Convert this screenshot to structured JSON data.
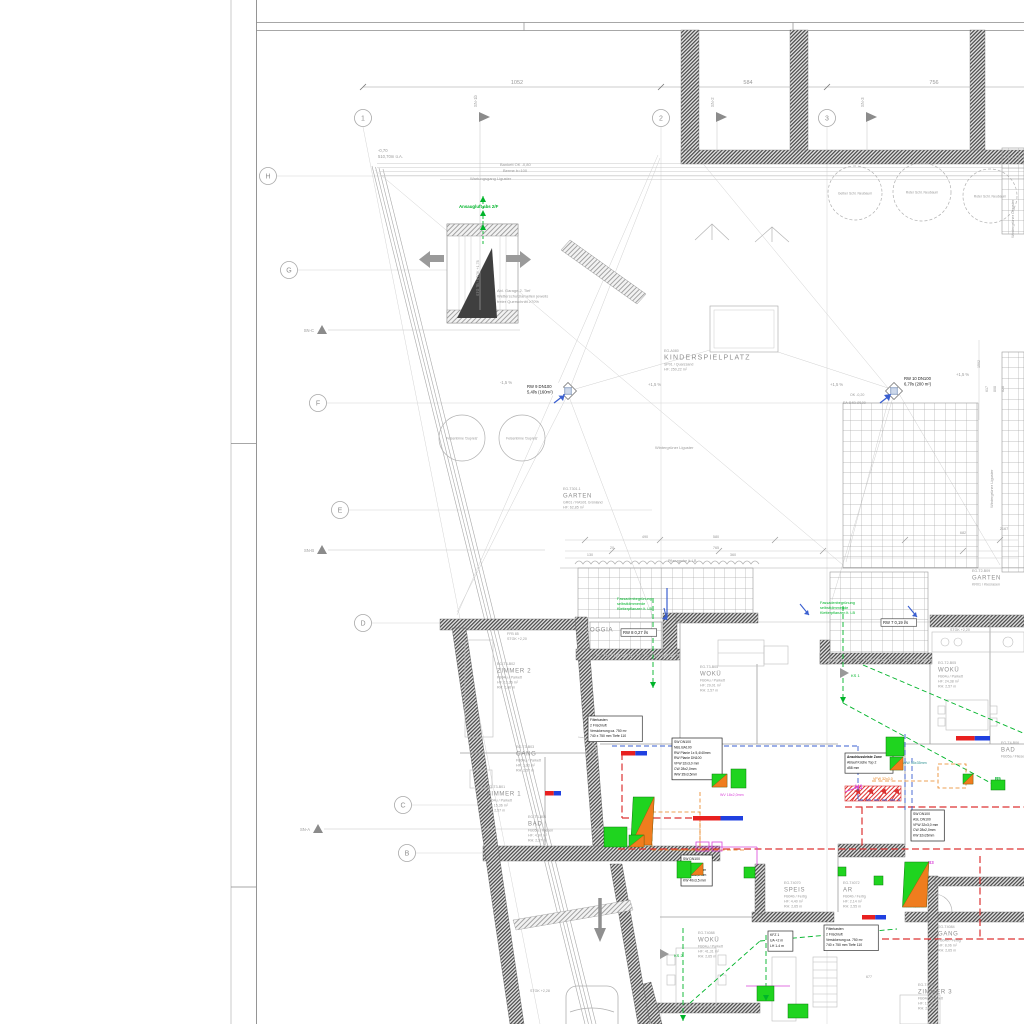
{
  "colors": {
    "gray": "#9a9a9a",
    "dgray": "#6f6f6f",
    "dark": "#333333",
    "green": "#00a52d",
    "bgreen": "#00b42a",
    "magenta": "#d944d9",
    "red": "#dd3333",
    "blue": "#3a5fd0",
    "teal": "#2b9090",
    "orange": "#e8821e",
    "fixture_green": "#1fd41f",
    "fixture_orange": "#ef7d1e",
    "bar_red": "#e82020",
    "bar_blue": "#2040e0"
  },
  "axes": {
    "cols": [
      {
        "label": "1",
        "x": 363,
        "y": 118
      },
      {
        "label": "2",
        "x": 661,
        "y": 118
      },
      {
        "label": "3",
        "x": 827,
        "y": 118
      }
    ],
    "rows": [
      {
        "label": "H",
        "x": 268,
        "y": 176
      },
      {
        "label": "G",
        "x": 289,
        "y": 270
      },
      {
        "label": "F",
        "x": 318,
        "y": 403
      },
      {
        "label": "E",
        "x": 340,
        "y": 510
      },
      {
        "label": "D",
        "x": 363,
        "y": 623
      },
      {
        "label": "C",
        "x": 403,
        "y": 805
      },
      {
        "label": "B",
        "x": 407,
        "y": 853
      }
    ],
    "flags": [
      {
        "label": "SN-1b",
        "x": 480,
        "y": 117,
        "drop": 310
      },
      {
        "label": "SN-2",
        "x": 717,
        "y": 117,
        "drop": 152
      },
      {
        "label": "SN-3",
        "x": 867,
        "y": 117,
        "drop": 152
      }
    ],
    "tris": [
      {
        "label": "SN-C",
        "x": 322,
        "y": 330,
        "ext": 520
      },
      {
        "label": "SN-B",
        "x": 322,
        "y": 550,
        "ext": 545
      },
      {
        "label": "SN-A",
        "x": 318,
        "y": 829,
        "ext": 700
      }
    ]
  },
  "dims_top": [
    {
      "t": "1052",
      "x": 517
    },
    {
      "t": "584",
      "x": 748
    },
    {
      "t": "756",
      "x": 934
    }
  ],
  "rooms": [
    {
      "id": "EG-A080",
      "name": "KINDERSPIELPLATZ",
      "sub": [
        "SP01 / Quarzsand",
        "HF:  250,22 m²"
      ],
      "x": 664,
      "y": 352,
      "big": 1
    },
    {
      "id": "EG-T301.1",
      "name": "GARTEN",
      "sub": [
        "GR01 / RAS01 Grünland",
        "HF:  62,85 m²"
      ],
      "x": 563,
      "y": 490
    },
    {
      "id": "EG-T2-B09",
      "name": "GARTEN",
      "sub": [
        "KR01 / Kiesrasen"
      ],
      "x": 972,
      "y": 572
    },
    {
      "id": "",
      "name": "LOGGIA",
      "sub": [],
      "x": 586,
      "y": 624
    },
    {
      "id": "EG-T3-B02",
      "name": "ZIMMER 2",
      "sub": [
        "FB04u / Parkett",
        "HF:  13,36 m²",
        "RH:  2,66 m"
      ],
      "x": 497,
      "y": 665
    },
    {
      "id": "EG-T3-B03",
      "name": "GANG",
      "sub": [
        "FB04u / Parkett",
        "HF:  3,03 m²",
        "RH:  2,57 m"
      ],
      "x": 516,
      "y": 748
    },
    {
      "id": "EG-T3-B01",
      "name": "ZIMMER 1",
      "sub": [
        "FB04u / Parkett",
        "HF:  15,36 m²",
        "RH:  2,57 m"
      ],
      "x": 487,
      "y": 788
    },
    {
      "id": "EG-T3-B04",
      "name": "BAD",
      "sub": [
        "FB05a / Fliesen",
        "HF:  4,97 m²",
        "RH:  2,57 m"
      ],
      "x": 528,
      "y": 818
    },
    {
      "id": "EG-T3-B05",
      "name": "WOKÜ",
      "sub": [
        "FB04u / Parkett",
        "HF:  29,01 m²",
        "RH:  2,57 m"
      ],
      "x": 700,
      "y": 668
    },
    {
      "id": "EG-T2-B05",
      "name": "WOKÜ",
      "sub": [
        "FB04u / Parkett",
        "HF:  24,38 m²",
        "RH:  2,57 m"
      ],
      "x": 938,
      "y": 664
    },
    {
      "id": "EG-T4070",
      "name": "SPEIS",
      "sub": [
        "FB04b / Fertig",
        "HF:  4,40 m²",
        "RH:  2,65 m"
      ],
      "x": 784,
      "y": 884
    },
    {
      "id": "EG-T4072",
      "name": "AR",
      "sub": [
        "FB04b / Fertig",
        "HF:  2,14 m²",
        "RH:  2,55 m"
      ],
      "x": 843,
      "y": 884
    },
    {
      "id": "EG-T4074",
      "name": "VR",
      "sub": [
        "FB04b / Fertig",
        "HF:  6,45 m²",
        "RH:  2,55 m"
      ],
      "x": 906,
      "y": 884
    },
    {
      "id": "EG-T4084",
      "name": "GANG",
      "sub": [
        "FB04b / Fertig",
        "HF:  8,06 m²",
        "RH:  2,65 m"
      ],
      "x": 938,
      "y": 928
    },
    {
      "id": "EG-T4086",
      "name": "ZIMMER 3",
      "sub": [
        "FB04u / Parkett",
        "HF:  13,06 m²",
        "RH:  2,65 m"
      ],
      "x": 918,
      "y": 986
    },
    {
      "id": "EG-T4088",
      "name": "WOKÜ",
      "sub": [
        "FB04u / Parkett",
        "HF:  41,31 m²",
        "RH:  2,65 m"
      ],
      "x": 698,
      "y": 934
    },
    {
      "id": "EG-T4-B06",
      "name": "BAD",
      "sub": [
        "FB05a / Fliesen"
      ],
      "x": 1001,
      "y": 744
    }
  ],
  "texts": [
    {
      "t": "-0,70",
      "x": 378,
      "y": 152,
      "s": 4.2,
      "c": "gray"
    },
    {
      "t": "510,70m ü.A.",
      "x": 378,
      "y": 158,
      "s": 4.2,
      "c": "gray"
    },
    {
      "t": "Bankett OK -0,80",
      "x": 500,
      "y": 166,
      "s": 4,
      "c": "gray"
    },
    {
      "t": "Berme b=100",
      "x": 503,
      "y": 172,
      "s": 4,
      "c": "gray"
    },
    {
      "t": "Wartungsgang Liguster",
      "x": 470,
      "y": 180,
      "s": 4,
      "c": "gray"
    },
    {
      "t": "Ansaugluft abs 2/F",
      "x": 459,
      "y": 208,
      "s": 4.4,
      "c": "bgreen",
      "b": 1
    },
    {
      "lines": [
        "Abl. Garage 2. Tief",
        "Wetterschutzlamellen jeweils",
        "freier Querschnitt ≥70%"
      ],
      "x": 497,
      "y": 292,
      "s": 4,
      "c": "gray",
      "lh": 5.6
    },
    {
      "t": "STG 7B / STGK +1,78",
      "x": 479,
      "y": 296,
      "s": 3.6,
      "c": "gray",
      "r": -90
    },
    {
      "t": "Wintergrüner Liguster",
      "x": 655,
      "y": 449,
      "s": 4,
      "c": "gray"
    },
    {
      "t": "Wintergrüner Liguster",
      "x": 993,
      "y": 508,
      "s": 4,
      "c": "gray",
      "r": -90
    },
    {
      "t": "Wintergrüner Liguster",
      "x": 1014,
      "y": 238,
      "s": 4,
      "c": "gray",
      "r": -90
    },
    {
      "t": "Pflanzgrube lt. LB",
      "x": 668,
      "y": 562,
      "s": 3.6,
      "c": "gray"
    },
    {
      "t": "-1,5 %",
      "x": 500,
      "y": 384,
      "s": 4.2,
      "c": "gray"
    },
    {
      "t": "+1,5 %",
      "x": 648,
      "y": 386,
      "s": 4.2,
      "c": "gray"
    },
    {
      "t": "+1,5 %",
      "x": 830,
      "y": 386,
      "s": 4.2,
      "c": "gray"
    },
    {
      "t": "+1,5 %",
      "x": 956,
      "y": 376,
      "s": 4.2,
      "c": "gray"
    },
    {
      "t": "OK -0,20",
      "x": 850,
      "y": 396,
      "s": 3.6,
      "c": "gray"
    },
    {
      "t": "EA-B4B-Ø100",
      "x": 843,
      "y": 404,
      "s": 3.6,
      "c": "gray"
    },
    {
      "t": "580",
      "x": 716,
      "y": 538,
      "s": 3.8,
      "c": "gray",
      "a": "middle"
    },
    {
      "t": "490",
      "x": 645,
      "y": 538,
      "s": 3.8,
      "c": "gray",
      "a": "middle"
    },
    {
      "t": "682",
      "x": 963,
      "y": 534,
      "s": 3.8,
      "c": "gray",
      "a": "middle"
    },
    {
      "t": "2167",
      "x": 1004,
      "y": 530,
      "s": 3.8,
      "c": "gray",
      "a": "middle"
    },
    {
      "t": "765",
      "x": 716,
      "y": 549,
      "s": 3.8,
      "c": "gray",
      "a": "middle"
    },
    {
      "t": "360",
      "x": 733,
      "y": 556,
      "s": 3.8,
      "c": "gray",
      "a": "middle"
    },
    {
      "t": "20",
      "x": 612,
      "y": 549,
      "s": 3.8,
      "c": "gray",
      "a": "middle"
    },
    {
      "t": "130",
      "x": 590,
      "y": 556,
      "s": 3.8,
      "c": "gray",
      "a": "middle"
    },
    {
      "t": "1502",
      "x": 980,
      "y": 368,
      "s": 3.6,
      "c": "gray",
      "r": -90
    },
    {
      "t": "617",
      "x": 988,
      "y": 392,
      "s": 3.6,
      "c": "gray",
      "r": -90
    },
    {
      "t": "808",
      "x": 996,
      "y": 392,
      "s": 3.6,
      "c": "gray",
      "r": -90
    },
    {
      "t": "828",
      "x": 1004,
      "y": 392,
      "s": 3.6,
      "c": "gray",
      "r": -90
    },
    {
      "lines": [
        "RFH RT",
        "FFB 85",
        "STGK +2,20"
      ],
      "x": 507,
      "y": 630,
      "s": 3.6,
      "c": "gray",
      "lh": 5
    },
    {
      "t": "STGK +2,20",
      "x": 950,
      "y": 631,
      "s": 3.6,
      "c": "gray"
    },
    {
      "t": "STGK +2,28",
      "x": 530,
      "y": 992,
      "s": 3.6,
      "c": "gray"
    },
    {
      "lines": [
        "Fassadenbegrünung",
        "selbstklimmende",
        "Kletterpflanzen lt. LB"
      ],
      "x": 617,
      "y": 600,
      "s": 3.8,
      "c": "bgreen",
      "lh": 5
    },
    {
      "lines": [
        "Fassadenbegrünung",
        "selbstklimmende",
        "Kletterpflanzen lt. LB"
      ],
      "x": 820,
      "y": 604,
      "s": 3.8,
      "c": "bgreen",
      "lh": 5
    },
    {
      "t": "H1",
      "x": 855,
      "y": 789,
      "s": 6,
      "c": "magenta",
      "b": 1
    },
    {
      "t": "B5",
      "x": 995,
      "y": 780,
      "s": 4.5,
      "c": "bgreen",
      "b": 1
    },
    {
      "t": "B3",
      "x": 928,
      "y": 864,
      "s": 4.5,
      "c": "magenta",
      "b": 1
    },
    {
      "t": "KS 2",
      "x": 674,
      "y": 957,
      "s": 4,
      "c": "bgreen"
    },
    {
      "t": "KS 1",
      "x": 851,
      "y": 677,
      "s": 4,
      "c": "bgreen"
    },
    {
      "t": "WV 18x2,0mm",
      "x": 720,
      "y": 796,
      "s": 3.6,
      "c": "magenta"
    },
    {
      "t": "WW 35x35mm",
      "x": 903,
      "y": 764,
      "s": 3.6,
      "c": "teal"
    },
    {
      "t": "VFW 32x3,0",
      "x": 873,
      "y": 780,
      "s": 3.6,
      "c": "orange"
    },
    {
      "t": "677",
      "x": 866,
      "y": 978,
      "s": 3.6,
      "c": "gray"
    },
    {
      "t": "340",
      "x": 836,
      "y": 944,
      "s": 3.6,
      "c": "gray"
    }
  ],
  "rw_tags": [
    {
      "t": "RW 8 0,27 l/s",
      "x": 623,
      "y": 634,
      "s": 4.2
    },
    {
      "t": "RW 7 0,19 l/s",
      "x": 883,
      "y": 624,
      "s": 4.2
    }
  ],
  "drains": [
    {
      "x": 568,
      "y": 391,
      "l1": "RW 9 DN100",
      "l2": "5,4l/s (160m²)",
      "lx": 527,
      "ly": 388
    },
    {
      "x": 894,
      "y": 391,
      "l1": "RW 10 DN100",
      "l2": "6,7l/s (200 m²)",
      "lx": 904,
      "ly": 380
    }
  ],
  "pipe_boxes": [
    {
      "x": 672,
      "y": 738,
      "lines": [
        "SW DN100",
        "NBL BA100",
        "RW Planie 1x 5,4/40mm",
        "RW Planie DN100",
        "VFW 32x3,0 mm",
        "CW 28x2,0mm",
        "WW 35x3,5mm"
      ]
    },
    {
      "x": 681,
      "y": 855,
      "lines": [
        "SW DN100",
        "ASL DN110",
        "WW 32x3,0mm",
        "CW 28x2,0 mm",
        "KW 40x3,5 mm"
      ]
    },
    {
      "x": 911,
      "y": 810,
      "lines": [
        "SW DN100",
        "ASL DN100",
        "VFW 32x3,0 mm",
        "CW 28x2,0mm",
        "KW 32x26mm"
      ]
    }
  ],
  "note_boxes": [
    {
      "x": 845,
      "y": 753,
      "lines": [
        "Anschlussleiste Zone",
        "Ablauf Küche Top 2",
        "d58 mm"
      ],
      "boldFirst": 1
    },
    {
      "x": 588,
      "y": 716,
      "lines": [
        "Filterkasten",
        "2 Frischluft",
        "Versickerung ca. 750 m³",
        "740 x 750 mm  Tiefe 110"
      ]
    },
    {
      "x": 824,
      "y": 925,
      "lines": [
        "Filterkasten",
        "2 Frischluft",
        "Versickerung ca. 750 m³",
        "740 x 750 mm  Tiefe 110"
      ]
    },
    {
      "x": 768,
      "y": 931,
      "lines": [
        "KFZ 1",
        "UA  +2 m",
        "LH  1-4 m"
      ]
    }
  ],
  "trees": [
    {
      "x": 462,
      "y": 438,
      "r": 23,
      "dash": 0,
      "label": "Felsenbirne 'Dupreis'"
    },
    {
      "x": 522,
      "y": 438,
      "r": 23,
      "dash": 0,
      "label": "Felsenbirne 'Dupreis'"
    },
    {
      "x": 855,
      "y": 193,
      "r": 27,
      "dash": 1,
      "label": "Gelber Schl. Neubaum"
    },
    {
      "x": 922,
      "y": 192,
      "r": 29,
      "dash": 1,
      "label": "Roter Schl. Neubaum"
    },
    {
      "x": 990,
      "y": 196,
      "r": 27,
      "dash": 1,
      "label": "Roter Schl. Neubaum"
    }
  ],
  "fixtures": [
    {
      "x": 731,
      "y": 769,
      "w": 15,
      "h": 19,
      "type": "g"
    },
    {
      "x": 712,
      "y": 774,
      "w": 15,
      "h": 13,
      "type": "go"
    },
    {
      "x": 675,
      "y": 797,
      "w": 21,
      "h": 48,
      "type": "tall"
    },
    {
      "x": 604,
      "y": 827,
      "w": 23,
      "h": 20,
      "type": "g"
    },
    {
      "x": 629,
      "y": 835,
      "w": 15,
      "h": 12,
      "type": "go"
    },
    {
      "x": 677,
      "y": 861,
      "w": 14,
      "h": 17,
      "type": "g"
    },
    {
      "x": 691,
      "y": 863,
      "w": 12,
      "h": 12,
      "type": "go"
    },
    {
      "x": 744,
      "y": 867,
      "w": 11,
      "h": 11,
      "type": "g"
    },
    {
      "x": 886,
      "y": 737,
      "w": 18,
      "h": 19,
      "type": "g"
    },
    {
      "x": 890,
      "y": 757,
      "w": 13,
      "h": 13,
      "type": "go"
    },
    {
      "x": 963,
      "y": 774,
      "w": 10,
      "h": 10,
      "type": "go"
    },
    {
      "x": 991,
      "y": 780,
      "w": 14,
      "h": 10,
      "type": "g"
    },
    {
      "x": 950,
      "y": 862,
      "w": 24,
      "h": 45,
      "type": "tall"
    },
    {
      "x": 838,
      "y": 867,
      "w": 8,
      "h": 9,
      "type": "g"
    },
    {
      "x": 874,
      "y": 876,
      "w": 9,
      "h": 9,
      "type": "g"
    },
    {
      "x": 757,
      "y": 986,
      "w": 17,
      "h": 15,
      "type": "g"
    },
    {
      "x": 788,
      "y": 1004,
      "w": 20,
      "h": 14,
      "type": "g"
    }
  ],
  "bars": [
    {
      "x": 621,
      "y": 751,
      "w": 26
    },
    {
      "x": 693,
      "y": 816,
      "w": 50
    },
    {
      "x": 956,
      "y": 736,
      "w": 34
    },
    {
      "x": 862,
      "y": 915,
      "w": 24
    },
    {
      "x": 545,
      "y": 791,
      "w": 16
    }
  ],
  "hedges": [
    {
      "x1": 575,
      "y": 564,
      "x2": 757
    },
    {
      "x1": 592,
      "y": 657,
      "x2": 676
    },
    {
      "x1": 828,
      "y": 662,
      "x2": 928
    }
  ],
  "green_arrows": [
    {
      "x": 653,
      "y": 682,
      "d": "down"
    },
    {
      "x": 843,
      "y": 697,
      "d": "down"
    },
    {
      "x": 483,
      "y": 202,
      "d": "up"
    },
    {
      "x": 483,
      "y": 216,
      "d": "up"
    },
    {
      "x": 483,
      "y": 230,
      "d": "up"
    },
    {
      "x": 683,
      "y": 1015,
      "d": "down"
    },
    {
      "x": 766,
      "y": 995,
      "d": "down"
    }
  ],
  "blue_arrows": [
    {
      "x1": 800,
      "y1": 604,
      "x2": 809,
      "y2": 615
    },
    {
      "x1": 908,
      "y1": 606,
      "x2": 917,
      "y2": 617
    },
    {
      "x1": 664,
      "y1": 608,
      "x2": 667,
      "y2": 620
    }
  ]
}
